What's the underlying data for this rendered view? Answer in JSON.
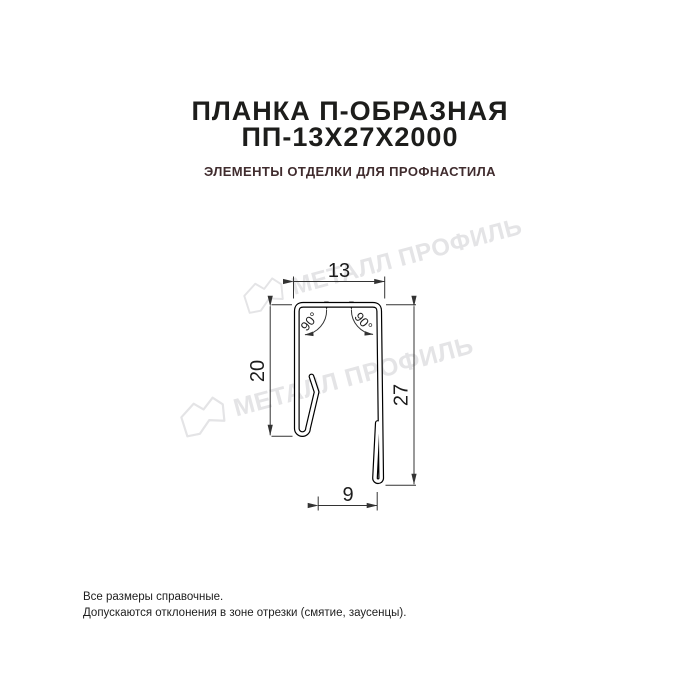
{
  "header": {
    "title_line1": "ПЛАНКА П-ОБРАЗНАЯ",
    "title_line2": "ПП-13Х27Х2000",
    "subtitle": "ЭЛЕМЕНТЫ ОТДЕЛКИ ДЛЯ ПРОФНАСТИЛА"
  },
  "drawing": {
    "dim_width": "13",
    "dim_left_height": "20",
    "dim_right_height": "27",
    "dim_bottom": "9",
    "angle_left": "90°",
    "angle_right": "90°"
  },
  "watermark": {
    "text": "МЕТАЛЛ ПРОФИЛЬ",
    "logo": "metall-profil-crown-icon",
    "color": "#e4e4e6"
  },
  "footer": {
    "line1": "Все размеры справочные.",
    "line2": "Допускаются отклонения в зоне отрезки (смятие, заусенцы)."
  },
  "colors": {
    "background": "#ffffff",
    "title": "#1d1d1b",
    "subtitle": "#402c2e",
    "profile_line": "#000000",
    "dimension_line": "#333333",
    "watermark": "#e4e4e6"
  }
}
